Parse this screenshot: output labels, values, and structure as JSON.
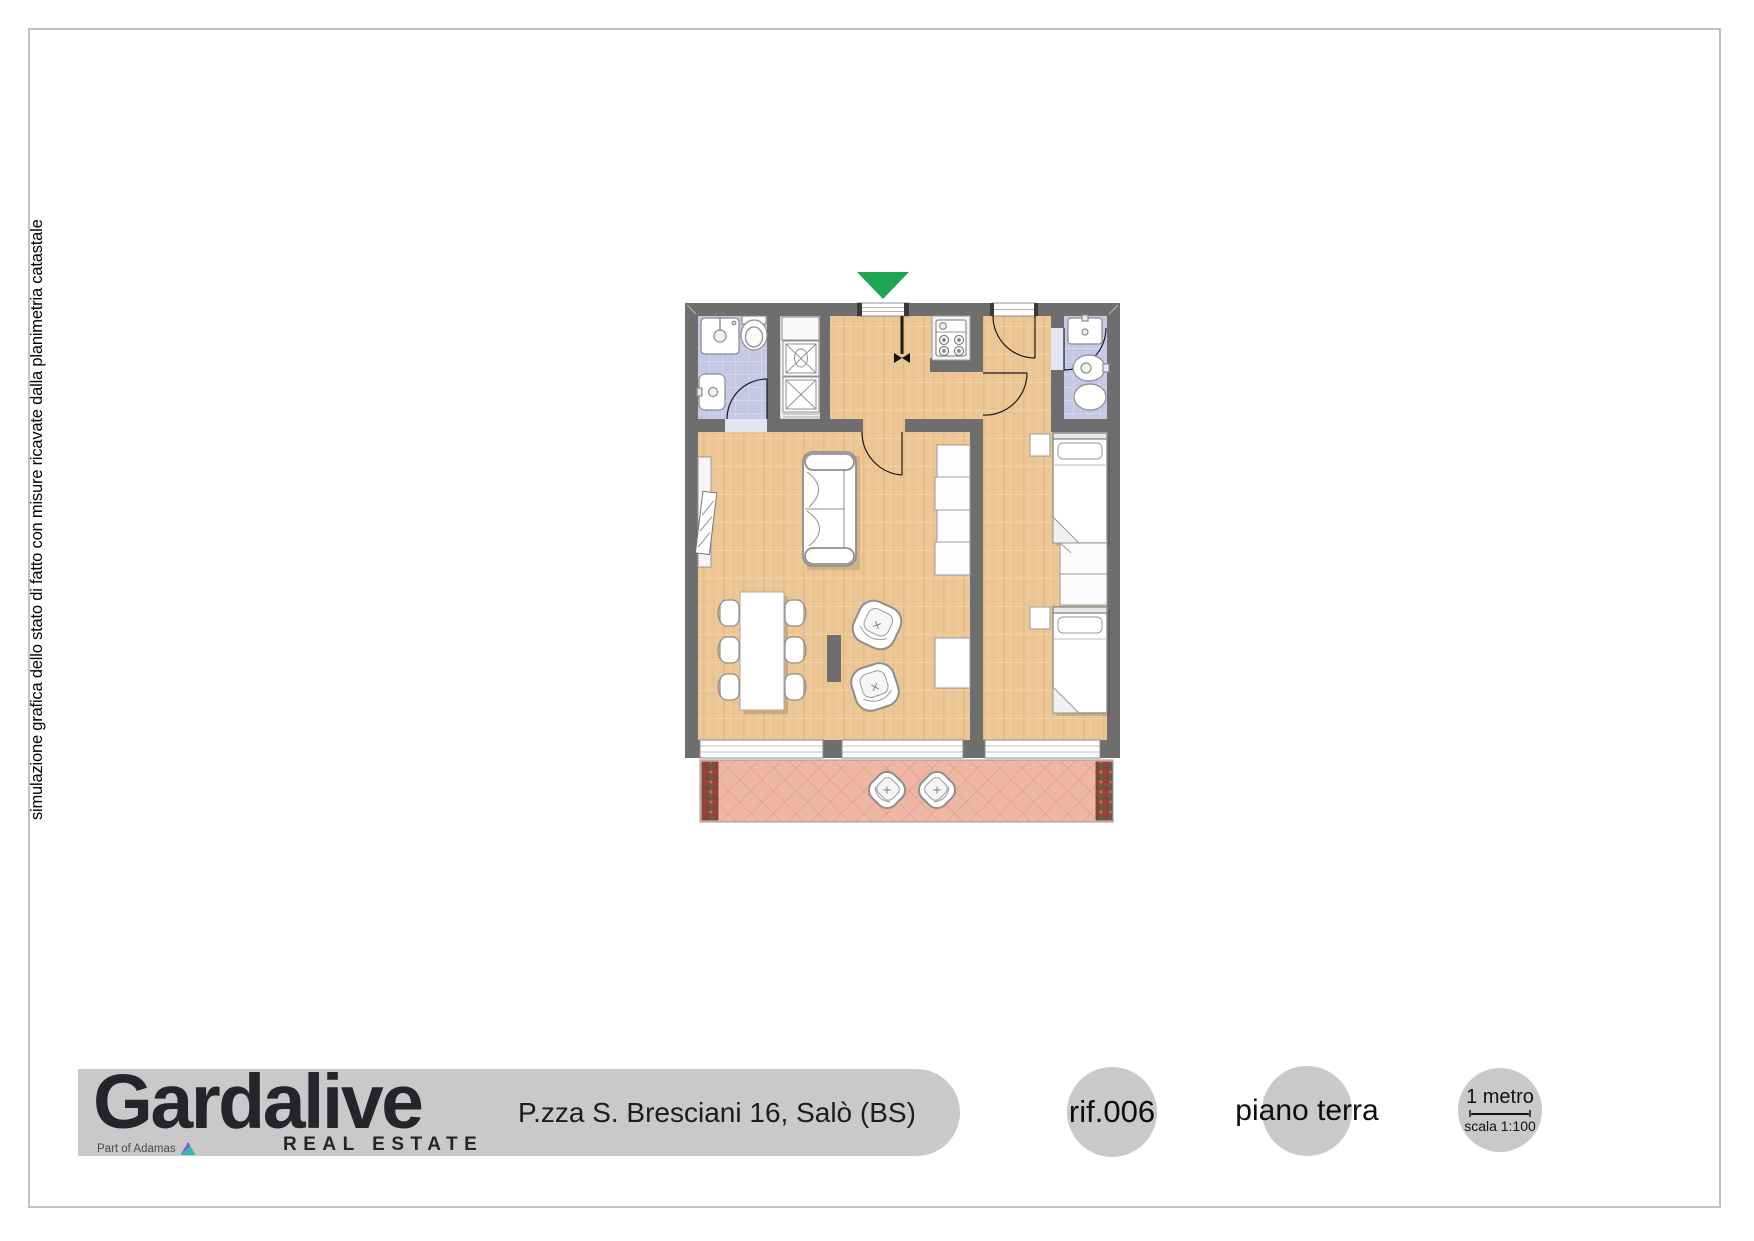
{
  "side_note": "simulazione grafica dello stato di fatto con misure ricavate dalla planimetria catastale",
  "plan": {
    "wall_color": "#6e6e6e",
    "entrance_marker_color": "#1ea553",
    "wood_floor_color": "#ecc795",
    "bathroom_tile_color": "#c5c8e4",
    "terrace_tile_color": "#efb6a4",
    "footprint": "two-room apartment with two bathrooms, laundry closet, kitchenette, living-dining room, twin bedroom and terrace"
  },
  "footer": {
    "band_color": "#c9c9c9",
    "logo_text": "Gardalive",
    "logo_subtitle": "REAL ESTATE",
    "logo_partner": "Part of Adamas",
    "address": "P.zza S. Bresciani 16, Salò (BS)",
    "reference": "rif.006",
    "floor_label": "piano terra",
    "scale_length_label": "1 metro",
    "scale_ratio_label": "scala 1:100"
  }
}
